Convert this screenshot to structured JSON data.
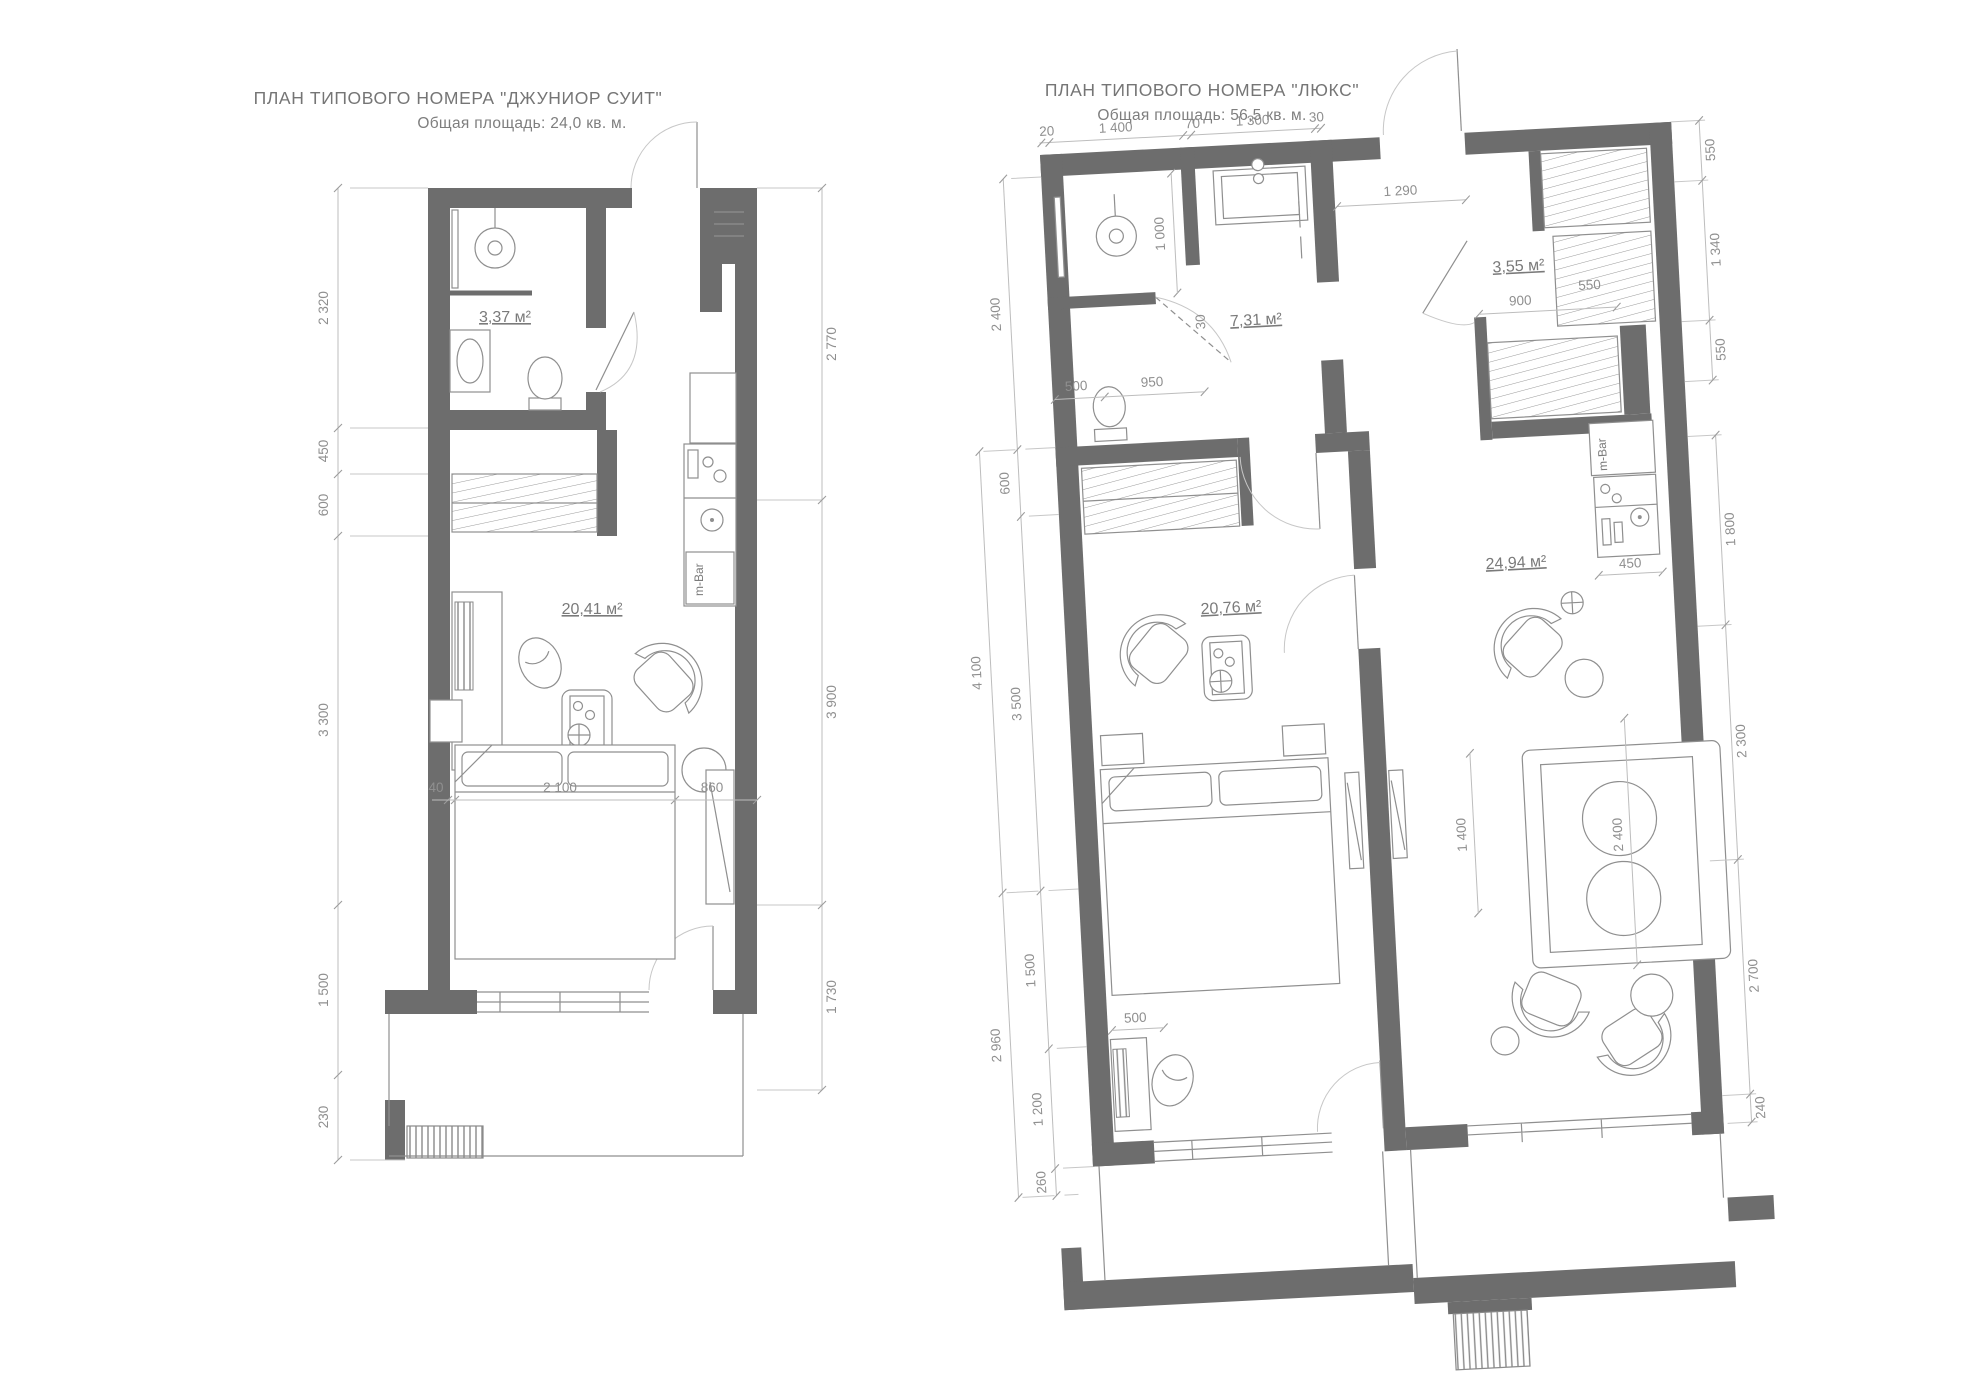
{
  "junior": {
    "title": "ПЛАН  ТИПОВОГО НОМЕРА \"ДЖУНИОР СУИТ\"",
    "subtitle": "Общая площадь: 24,0 кв. м.",
    "areas": {
      "bathroom": "3,37 м²",
      "main": "20,41 м²"
    },
    "dims_left": [
      "2 320",
      "450",
      "600",
      "3 300",
      "1 500",
      "230"
    ],
    "dims_right": [
      "2 770",
      "3 900",
      "1 730"
    ],
    "dims_bed": [
      "40",
      "2 100",
      "860"
    ],
    "minibar": "m-Bar"
  },
  "lux": {
    "title": "ПЛАН  ТИПОВОГО НОМЕРА \"ЛЮКС\"",
    "subtitle": "Общая площадь: 56,5 кв. м.",
    "areas": {
      "bathroom": "7,31 м²",
      "wardrobe": "3,55 м²",
      "bedroom": "20,76 м²",
      "living": "24,94 м²"
    },
    "dims_top": [
      "20",
      "1 400",
      "70",
      "1 300",
      "30"
    ],
    "dim_entry": "1 290",
    "dims_left_inner": [
      "2 400",
      "600",
      "3 500",
      "1 500",
      "1 200",
      "260"
    ],
    "dims_left_outer": [
      "4 100",
      "2 960"
    ],
    "dims_right": [
      "550",
      "1 340",
      "550",
      "1 800",
      "2 300",
      "2 700",
      "240"
    ],
    "dims_bath": [
      "1 000",
      "30",
      "500",
      "950"
    ],
    "dims_wardrobe": [
      "900",
      "550"
    ],
    "dim_kitchen": "450",
    "dims_living": [
      "1 400",
      "2 400"
    ],
    "dim_desk": "500",
    "minibar": "m-Bar"
  }
}
